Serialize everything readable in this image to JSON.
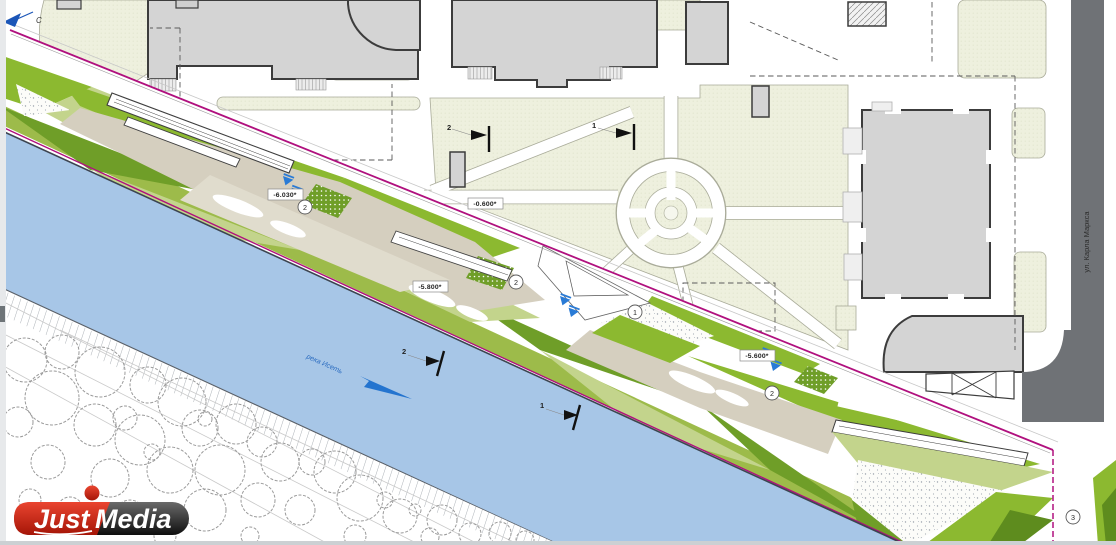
{
  "meta": {
    "kind": "riverfront landscape masterplan drawing"
  },
  "north": {
    "label": "С"
  },
  "river": {
    "name": "река Исеть",
    "water_color": "#a7c6e7",
    "arrow_color": "#2474cf"
  },
  "street": {
    "name": "ул. Карла Маркса",
    "road_color": "#6f7276"
  },
  "elevations": [
    {
      "v": "-6.030*"
    },
    {
      "v": "-0.600*"
    },
    {
      "v": "-5.800*"
    },
    {
      "v": "-5.600*"
    }
  ],
  "badges": [
    {
      "n": "2"
    },
    {
      "n": "2"
    },
    {
      "n": "1"
    },
    {
      "n": "2"
    },
    {
      "n": "3"
    }
  ],
  "sections": [
    {
      "n": "2"
    },
    {
      "n": "1"
    },
    {
      "n": "2"
    },
    {
      "n": "1"
    }
  ],
  "watermark": {
    "first": "Just",
    "second": "Media",
    "red": "#cf2a1b",
    "dark": "#1e1e1e"
  },
  "colors": {
    "boundary_magenta": "#b0107e",
    "green_bright": "#8cb930",
    "green_mid": "#9dbb4a",
    "green_light": "#c3d48c",
    "green_dark": "#6f9e28",
    "tan_path": "#d5cfbf",
    "cream_block": "#eef0de",
    "building_gray": "#d4d4d4",
    "building_outline": "#3c3c3c"
  }
}
